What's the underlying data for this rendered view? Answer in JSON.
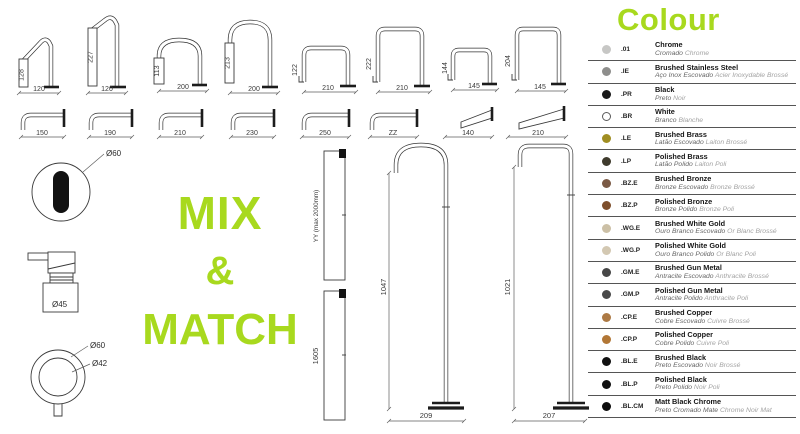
{
  "colors": {
    "accent_green": "#a8d91e",
    "line": "#333333"
  },
  "mix_match": {
    "line1": "MIX",
    "line2": "&",
    "line3": "MATCH"
  },
  "top_spouts": [
    {
      "h": "128",
      "w": "120"
    },
    {
      "h": "227",
      "w": "120"
    },
    {
      "h": "113",
      "w": "200"
    },
    {
      "h": "213",
      "w": "200"
    },
    {
      "h": "122",
      "w": "210"
    },
    {
      "h": "222",
      "w": "210"
    },
    {
      "h": "144",
      "w": "145"
    },
    {
      "h": "204",
      "w": "145"
    }
  ],
  "wall_spouts": [
    {
      "w": "150"
    },
    {
      "w": "190"
    },
    {
      "w": "210"
    },
    {
      "w": "230"
    },
    {
      "w": "250"
    },
    {
      "w": "ZZ"
    },
    {
      "w": "140"
    },
    {
      "w": "210"
    }
  ],
  "components": {
    "oval_escutcheon": {
      "label": "Ø60"
    },
    "lever_handle": {
      "label": "Ø45"
    },
    "ring_handle": {
      "outer_label": "Ø60",
      "inner_label": "Ø42"
    }
  },
  "ceiling_spouts": [
    {
      "h": "YY (max 2000mm)"
    },
    {
      "h": "1605"
    }
  ],
  "floor_spouts": [
    {
      "h": "1047",
      "w": "209"
    },
    {
      "h": "1021",
      "w": "207"
    }
  ],
  "colour_legend": {
    "title": "Colour",
    "items": [
      {
        "code": ".01",
        "name": "Chrome",
        "sub_pt": "Cromado",
        "sub_fr": "Chrome",
        "swatch": "#c7c7c5",
        "outlined": false
      },
      {
        "code": ".IE",
        "name": "Brushed Stainless Steel",
        "sub_pt": "Aço Inox Escovado",
        "sub_fr": "Acier Inoxydable Brossé",
        "swatch": "#8e8e8c",
        "outlined": false
      },
      {
        "code": ".PR",
        "name": "Black",
        "sub_pt": "Preto",
        "sub_fr": "Noir",
        "swatch": "#1a1a1a",
        "outlined": false
      },
      {
        "code": ".BR",
        "name": "White",
        "sub_pt": "Branco",
        "sub_fr": "Blanche",
        "swatch": "#ffffff",
        "outlined": true
      },
      {
        "code": ".LE",
        "name": "Brushed Brass",
        "sub_pt": "Latão Escovado",
        "sub_fr": "Laiton Brossé",
        "swatch": "#a08e22",
        "outlined": false
      },
      {
        "code": ".LP",
        "name": "Polished Brass",
        "sub_pt": "Latão Polido",
        "sub_fr": "Laiton Poli",
        "swatch": "#3f3b2d",
        "outlined": false
      },
      {
        "code": ".BZ.E",
        "name": "Brushed Bronze",
        "sub_pt": "Bronze Escovado",
        "sub_fr": "Bronze Brossé",
        "swatch": "#7b5a45",
        "outlined": false
      },
      {
        "code": ".BZ.P",
        "name": "Polished Bronze",
        "sub_pt": "Bronze Polido",
        "sub_fr": "Bronze Poli",
        "swatch": "#7e4f2c",
        "outlined": false
      },
      {
        "code": ".WG.E",
        "name": "Brushed White Gold",
        "sub_pt": "Ouro Branco Escovado",
        "sub_fr": "Or Blanc Brossé",
        "swatch": "#ccc0a6",
        "outlined": false
      },
      {
        "code": ".WG.P",
        "name": "Polished White Gold",
        "sub_pt": "Ouro Branco Polido",
        "sub_fr": "Or Blanc Poli",
        "swatch": "#d3c8b2",
        "outlined": false
      },
      {
        "code": ".GM.E",
        "name": "Brushed Gun Metal",
        "sub_pt": "Antracite Escovado",
        "sub_fr": "Anthracite Brossé",
        "swatch": "#474747",
        "outlined": false
      },
      {
        "code": ".GM.P",
        "name": "Polished Gun Metal",
        "sub_pt": "Antracite Polido",
        "sub_fr": "Anthracite Poli",
        "swatch": "#4a4a4a",
        "outlined": false
      },
      {
        "code": ".CP.E",
        "name": "Brushed Copper",
        "sub_pt": "Cobre Escovado",
        "sub_fr": "Cuivre Brossé",
        "swatch": "#ad7a45",
        "outlined": false
      },
      {
        "code": ".CP.P",
        "name": "Polished Copper",
        "sub_pt": "Cobre Polido",
        "sub_fr": "Cuivre Poli",
        "swatch": "#b27736",
        "outlined": false
      },
      {
        "code": ".BL.E",
        "name": "Brushed Black",
        "sub_pt": "Preto Escovado",
        "sub_fr": "Noir Brossé",
        "swatch": "#111111",
        "outlined": false
      },
      {
        "code": ".BL.P",
        "name": "Polished Black",
        "sub_pt": "Preto Polido",
        "sub_fr": "Noir Poli",
        "swatch": "#111111",
        "outlined": false
      },
      {
        "code": ".BL.CM",
        "name": "Matt Black Chrome",
        "sub_pt": "Preto Cromado Mate",
        "sub_fr": "Chrome Noir Mat",
        "swatch": "#0d0d0d",
        "outlined": false
      }
    ]
  }
}
